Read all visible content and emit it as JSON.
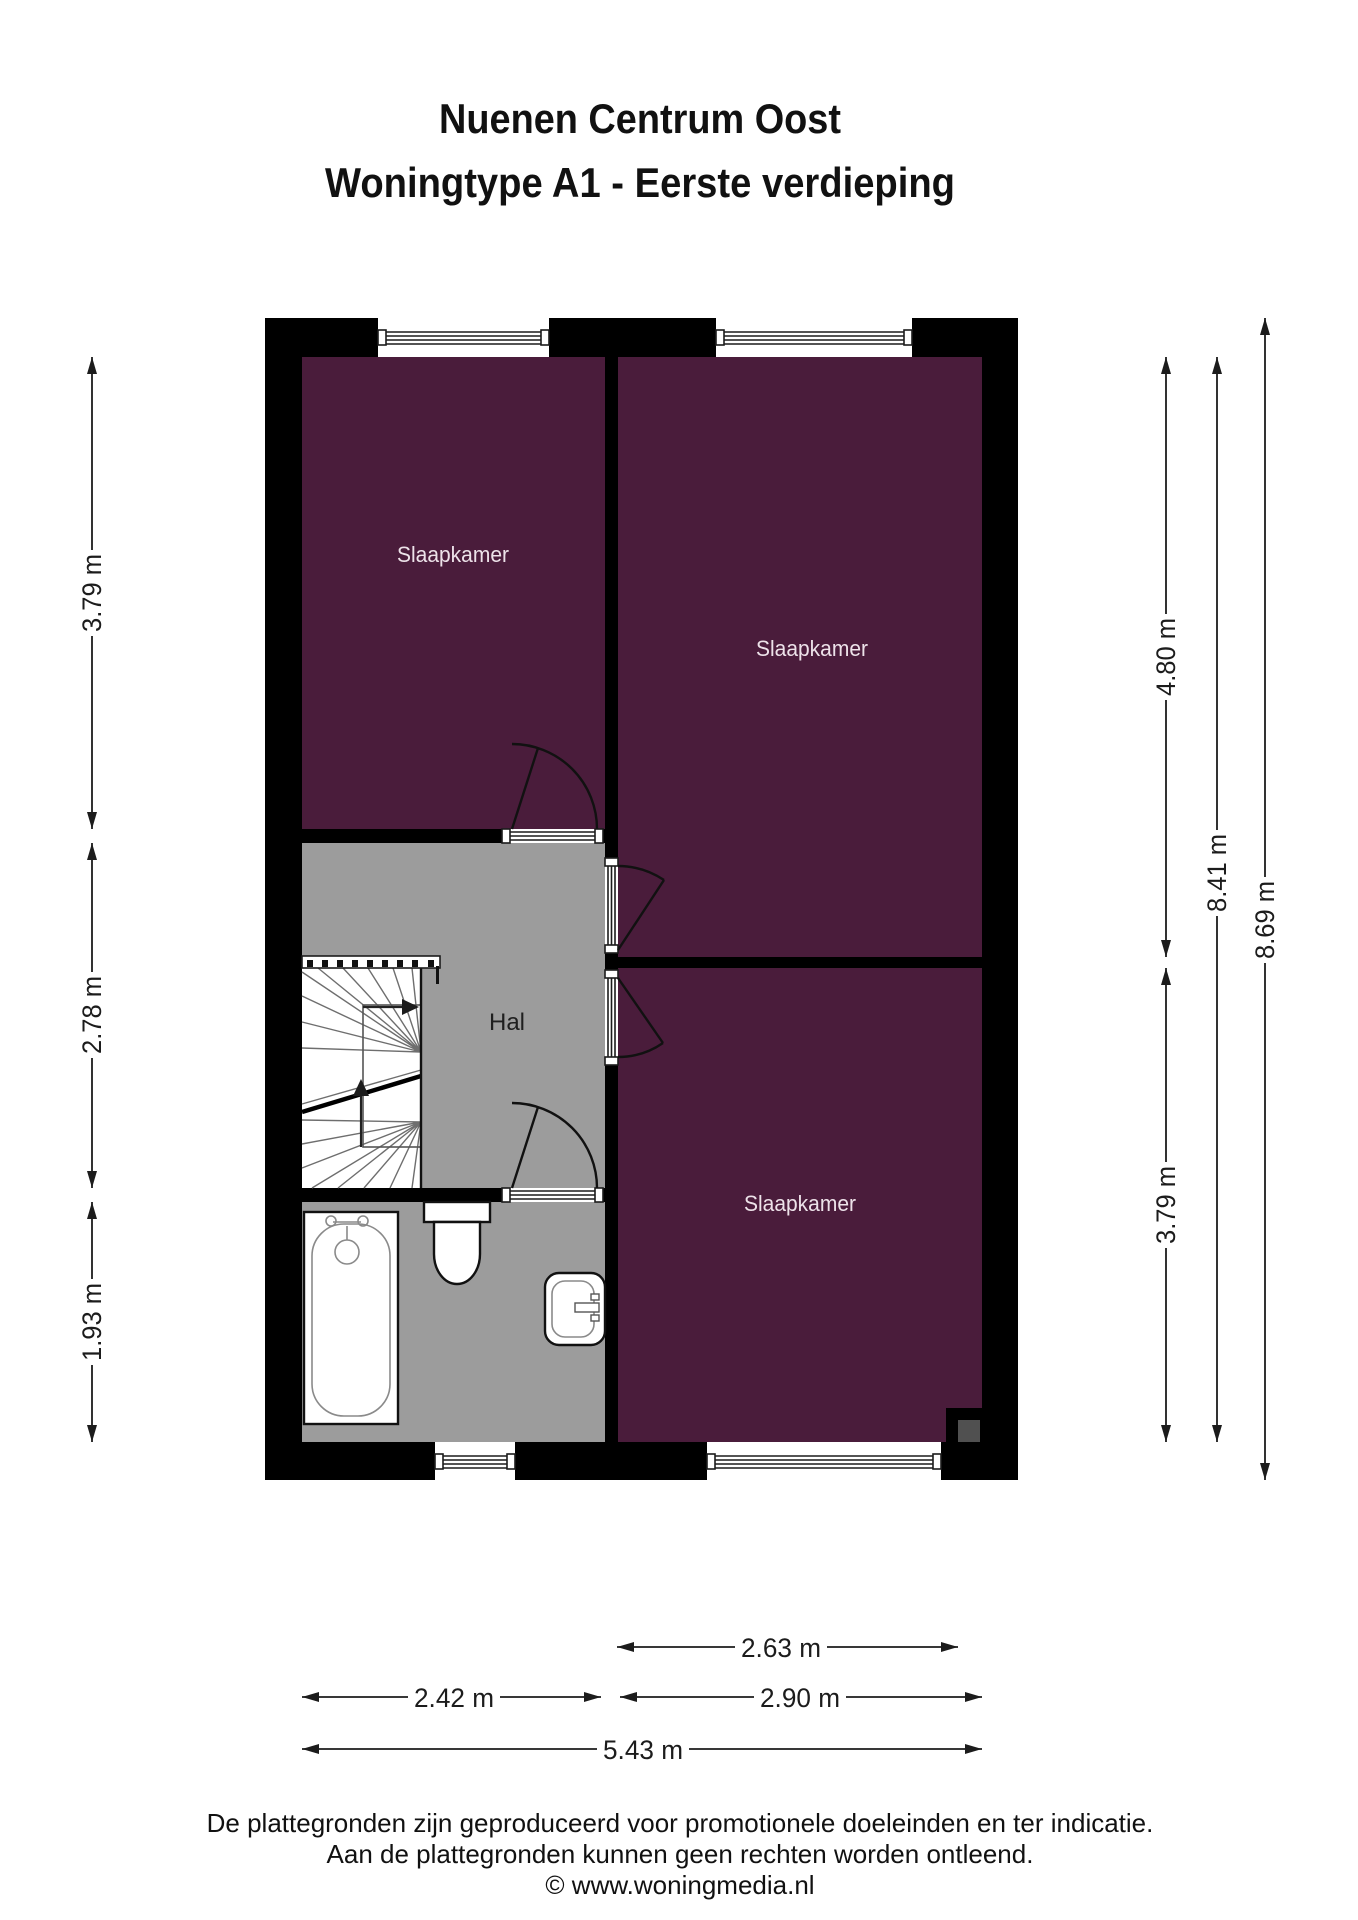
{
  "title": {
    "line1": "Nuenen Centrum Oost",
    "line2": "Woningtype A1 - Eerste verdieping"
  },
  "rooms": {
    "bedroom_top_left": {
      "label": "Slaapkamer"
    },
    "bedroom_top_right": {
      "label": "Slaapkamer"
    },
    "bedroom_bottom_right": {
      "label": "Slaapkamer"
    },
    "hall": {
      "label": "Hal"
    }
  },
  "dimensions": {
    "left": [
      {
        "value": "3.79 m"
      },
      {
        "value": "2.78 m"
      },
      {
        "value": "1.93 m"
      }
    ],
    "right": [
      {
        "value": "4.80 m"
      },
      {
        "value": "3.79 m"
      },
      {
        "value": "8.41 m"
      },
      {
        "value": "8.69 m"
      }
    ],
    "bottom": [
      {
        "value": "2.63 m"
      },
      {
        "value": "2.42 m"
      },
      {
        "value": "2.90 m"
      },
      {
        "value": "5.43 m"
      }
    ]
  },
  "footer": {
    "line1": "De plattegronden zijn geproduceerd voor promotionele doeleinden en ter indicatie.",
    "line2": "Aan de plattegronden kunnen geen rechten worden ontleend.",
    "line3": "© www.woningmedia.nl"
  },
  "colors": {
    "room_fill": "#4A1C3B",
    "floor": "#9C9C9C",
    "wall": "#000000",
    "shaft": "#505050",
    "room_label": "#EDE2E9",
    "text": "#111111"
  }
}
